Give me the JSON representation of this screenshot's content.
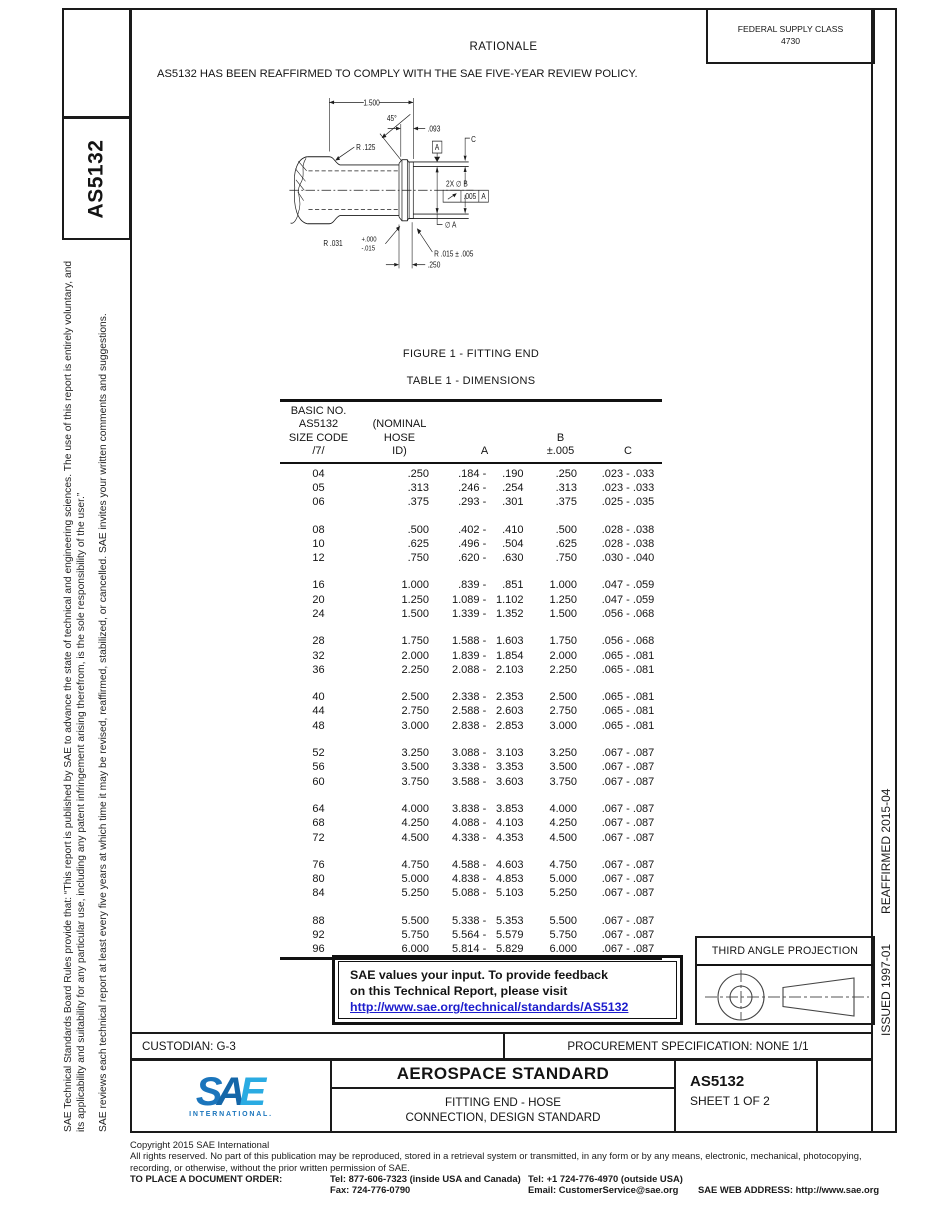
{
  "header": {
    "rationale_title": "RATIONALE",
    "rationale_text": "AS5132 HAS BEEN REAFFIRMED TO COMPLY WITH THE SAE FIVE-YEAR REVIEW POLICY.",
    "federal_supply_class_label": "FEDERAL SUPPLY CLASS",
    "federal_supply_class_value": "4730"
  },
  "sidebar_left": {
    "doc_code": "AS5132",
    "disclaimer_1": "SAE Technical Standards Board Rules provide that: “This report is published by SAE to advance the state of technical and engineering sciences. The use of this report is entirely voluntary, and its applicability and suitability for any particular use, including any patent infringement arising therefrom, is the sole responsibility of the user.”",
    "disclaimer_2": "SAE reviews each technical report at least every five years at which time it may be revised, reaffirmed, stabilized, or cancelled. SAE invites your written comments and suggestions."
  },
  "sidebar_right": {
    "issued": "ISSUED 1997-01",
    "reaffirmed": "REAFFIRMED 2015-04"
  },
  "figure": {
    "caption": "FIGURE 1 - FITTING END",
    "labels": {
      "dim_length": "1.500",
      "angle": "45°",
      "dim_093": ".093",
      "r125": "R .125",
      "datum_a": "A",
      "c_label": "C",
      "dia_b": "2X ∅ B",
      "fcf_tol": ".005",
      "fcf_datum": "A",
      "dia_a": "∅ A",
      "r031": "R .031",
      "r031_plus": "+.000",
      "r031_minus": "-.015",
      "r015": "R .015 ± .005",
      "dim_250": ".250"
    }
  },
  "table": {
    "caption": "TABLE 1 - DIMENSIONS",
    "headers": {
      "col1": "BASIC NO.\nAS5132\nSIZE CODE\n/7/",
      "col2": "(NOMINAL\nHOSE\nID)",
      "col3": "A",
      "col4": "B\n±.005",
      "col5": "C"
    },
    "groups": [
      [
        [
          "04",
          ".250",
          ".184",
          ".190",
          ".250",
          ".023 - .033"
        ],
        [
          "05",
          ".313",
          ".246",
          ".254",
          ".313",
          ".023 - .033"
        ],
        [
          "06",
          ".375",
          ".293",
          ".301",
          ".375",
          ".025 - .035"
        ]
      ],
      [
        [
          "08",
          ".500",
          ".402",
          ".410",
          ".500",
          ".028 - .038"
        ],
        [
          "10",
          ".625",
          ".496",
          ".504",
          ".625",
          ".028 - .038"
        ],
        [
          "12",
          ".750",
          ".620",
          ".630",
          ".750",
          ".030 - .040"
        ]
      ],
      [
        [
          "16",
          "1.000",
          ".839",
          ".851",
          "1.000",
          ".047 - .059"
        ],
        [
          "20",
          "1.250",
          "1.089",
          "1.102",
          "1.250",
          ".047 - .059"
        ],
        [
          "24",
          "1.500",
          "1.339",
          "1.352",
          "1.500",
          ".056 - .068"
        ]
      ],
      [
        [
          "28",
          "1.750",
          "1.588",
          "1.603",
          "1.750",
          ".056 - .068"
        ],
        [
          "32",
          "2.000",
          "1.839",
          "1.854",
          "2.000",
          ".065 - .081"
        ],
        [
          "36",
          "2.250",
          "2.088",
          "2.103",
          "2.250",
          ".065 - .081"
        ]
      ],
      [
        [
          "40",
          "2.500",
          "2.338",
          "2.353",
          "2.500",
          ".065 - .081"
        ],
        [
          "44",
          "2.750",
          "2.588",
          "2.603",
          "2.750",
          ".065 - .081"
        ],
        [
          "48",
          "3.000",
          "2.838",
          "2.853",
          "3.000",
          ".065 - .081"
        ]
      ],
      [
        [
          "52",
          "3.250",
          "3.088",
          "3.103",
          "3.250",
          ".067 - .087"
        ],
        [
          "56",
          "3.500",
          "3.338",
          "3.353",
          "3.500",
          ".067 - .087"
        ],
        [
          "60",
          "3.750",
          "3.588",
          "3.603",
          "3.750",
          ".067 - .087"
        ]
      ],
      [
        [
          "64",
          "4.000",
          "3.838",
          "3.853",
          "4.000",
          ".067 - .087"
        ],
        [
          "68",
          "4.250",
          "4.088",
          "4.103",
          "4.250",
          ".067 - .087"
        ],
        [
          "72",
          "4.500",
          "4.338",
          "4.353",
          "4.500",
          ".067 - .087"
        ]
      ],
      [
        [
          "76",
          "4.750",
          "4.588",
          "4.603",
          "4.750",
          ".067 - .087"
        ],
        [
          "80",
          "5.000",
          "4.838",
          "4.853",
          "5.000",
          ".067 - .087"
        ],
        [
          "84",
          "5.250",
          "5.088",
          "5.103",
          "5.250",
          ".067 - .087"
        ]
      ],
      [
        [
          "88",
          "5.500",
          "5.338",
          "5.353",
          "5.500",
          ".067 - .087"
        ],
        [
          "92",
          "5.750",
          "5.564",
          "5.579",
          "5.750",
          ".067 - .087"
        ],
        [
          "96",
          "6.000",
          "5.814",
          "5.829",
          "6.000",
          ".067 - .087"
        ]
      ]
    ]
  },
  "feedback_box": {
    "line1": "SAE values your input. To provide feedback",
    "line2": "on this Technical Report, please visit",
    "link": "http://www.sae.org/technical/standards/AS5132"
  },
  "projection": {
    "title": "THIRD ANGLE PROJECTION"
  },
  "title_block": {
    "custodian": "CUSTODIAN: G-3",
    "procurement": "PROCUREMENT SPECIFICATION: NONE 1/1",
    "logo_s": "S",
    "logo_a": "A",
    "logo_e": "E",
    "logo_sub": "INTERNATIONAL.",
    "doc_type": "AEROSPACE STANDARD",
    "doc_title_line1": "FITTING END - HOSE",
    "doc_title_line2": "CONNECTION, DESIGN STANDARD",
    "doc_number": "AS5132",
    "sheet": "SHEET 1 OF 2"
  },
  "footer": {
    "copyright": "Copyright 2015 SAE International",
    "rights_line1": "All rights reserved. No part of this publication may be reproduced, stored in a retrieval system or transmitted, in any form or by any means, electronic, mechanical, photocopying,",
    "rights_line2": "recording, or otherwise, without the prior written permission of SAE.",
    "order_label": "TO PLACE A DOCUMENT ORDER:",
    "tel_inside": "Tel: 877-606-7323 (inside USA and Canada)",
    "tel_outside": "Tel: +1 724-776-4970 (outside USA)",
    "fax": "Fax: 724-776-0790",
    "email": "Email: CustomerService@sae.org",
    "web": "SAE WEB ADDRESS: http://www.sae.org"
  }
}
